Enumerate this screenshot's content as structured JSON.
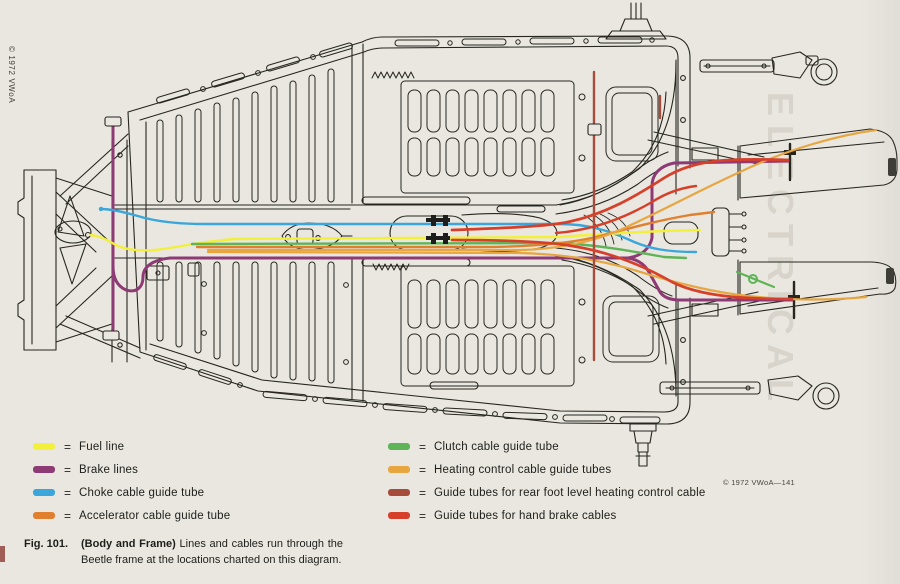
{
  "page": {
    "copyright_side": "© 1972 VWoA",
    "copyright_plate": "© 1972 VWoA—141",
    "watermark": "ELECTRICAL"
  },
  "colors": {
    "fuel": "#f3ef3d",
    "brake": "#8e3a74",
    "choke": "#3aa6db",
    "accelerator": "#e0802e",
    "clutch": "#5eb457",
    "heating": "#e7a63f",
    "rear_heating": "#a74b3a",
    "handbrake": "#d6402a",
    "paper": "#e9e7e0",
    "ink": "#26261f"
  },
  "legend": {
    "equals": "=",
    "left": [
      {
        "key": "fuel",
        "label": "Fuel line"
      },
      {
        "key": "brake",
        "label": "Brake lines"
      },
      {
        "key": "choke",
        "label": "Choke cable guide tube"
      },
      {
        "key": "accelerator",
        "label": "Accelerator cable guide tube"
      }
    ],
    "right": [
      {
        "key": "clutch",
        "label": "Clutch cable guide tube"
      },
      {
        "key": "heating",
        "label": "Heating control cable guide tubes"
      },
      {
        "key": "rear_heating",
        "label": "Guide tubes for rear foot level heating control cable"
      },
      {
        "key": "handbrake",
        "label": "Guide tubes for hand brake cables"
      }
    ]
  },
  "caption": {
    "fig_label": "Fig. 101.",
    "title": "(Body and Frame)",
    "text": "Lines and cables run through the Beetle frame at the locations charted on this diagram."
  }
}
